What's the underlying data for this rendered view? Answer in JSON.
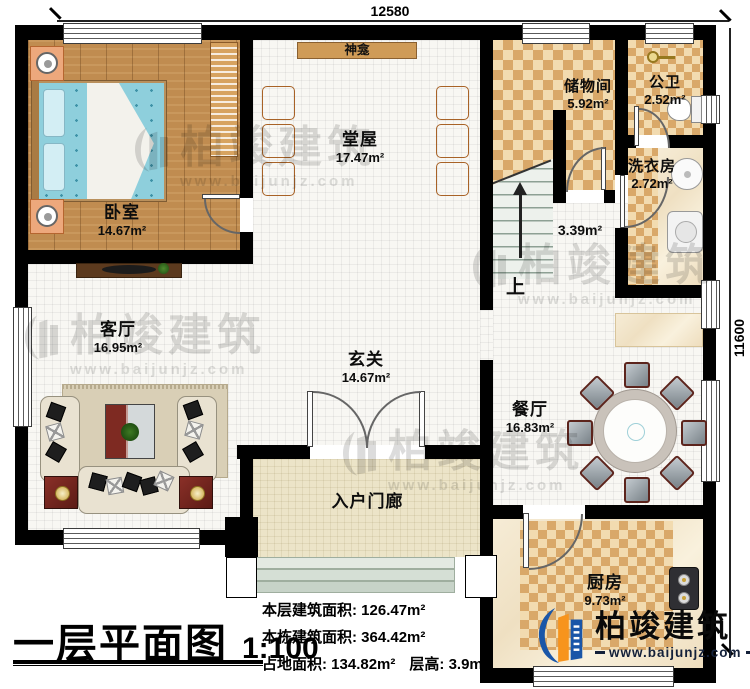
{
  "plan": {
    "title": "一层平面图",
    "scale": "1:100",
    "dim_top": "12580",
    "dim_right": "11600"
  },
  "rooms": {
    "bedroom": {
      "name": "卧室",
      "area": "14.67m²"
    },
    "hall": {
      "name": "堂屋",
      "area": "17.47m²"
    },
    "shrine": {
      "name": "神龛"
    },
    "storage": {
      "name": "储物间",
      "area": "5.92m²"
    },
    "bath": {
      "name": "公卫",
      "area": "2.52m²"
    },
    "laundry": {
      "name": "洗衣房",
      "area": "2.72m²"
    },
    "stairs": {
      "up": "上",
      "area": "3.39m²"
    },
    "living": {
      "name": "客厅",
      "area": "16.95m²"
    },
    "foyer": {
      "name": "玄关",
      "area": "14.67m²"
    },
    "dining": {
      "name": "餐厅",
      "area": "16.83m²"
    },
    "kitchen": {
      "name": "厨房",
      "area": "9.73m²"
    },
    "porch": {
      "name": "入户门廊"
    }
  },
  "stats": {
    "line1_label": "本层建筑面积:",
    "line1_value": "126.47m²",
    "line2_label": "本栋建筑面积:",
    "line2_value": "364.42m²",
    "line3_label": "占地面积:",
    "line3_value": "134.82m²",
    "line3b_label": "层高:",
    "line3b_value": "3.9m"
  },
  "logo": {
    "name": "柏竣建筑",
    "url": "www.baijunjz.com"
  },
  "watermark": {
    "text": "柏竣建筑",
    "url": "www.baijunjz.com"
  },
  "colors": {
    "wall": "#000000",
    "checker_dark": "#d9a869",
    "checker_light": "#f2dbb0",
    "wood": "#c08c50",
    "logo_blue": "#1a56a8",
    "logo_orange": "#f7941d"
  }
}
